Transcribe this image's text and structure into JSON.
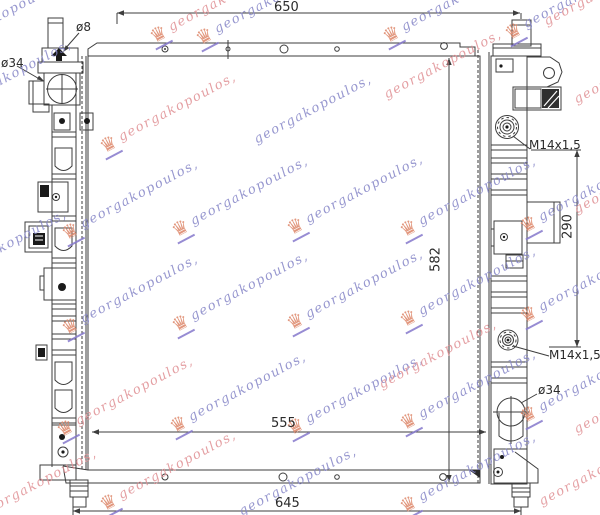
{
  "drawing": {
    "title": "radiator-technical-drawing",
    "dimensions": {
      "top_width": "650",
      "bottom_width": "645",
      "core_width": "555",
      "core_height": "582",
      "port_spacing": "290"
    },
    "callouts": {
      "top_left_small_port": "ø8",
      "top_left_inlet": "ø34",
      "upper_thread_port": "M14x1,5",
      "lower_thread_port": "M14x1,5",
      "bottom_outlet": "ø34"
    },
    "line_color": "#3d3d3d"
  },
  "watermark": {
    "text": "georgakopoulos,",
    "logo_glyph": "♛",
    "logo_name": "crown-logo",
    "colors": {
      "blue": "#8585c7",
      "pink": "#e08f93",
      "logo": "#dd8668",
      "logo_accent": "#8578cc"
    }
  }
}
